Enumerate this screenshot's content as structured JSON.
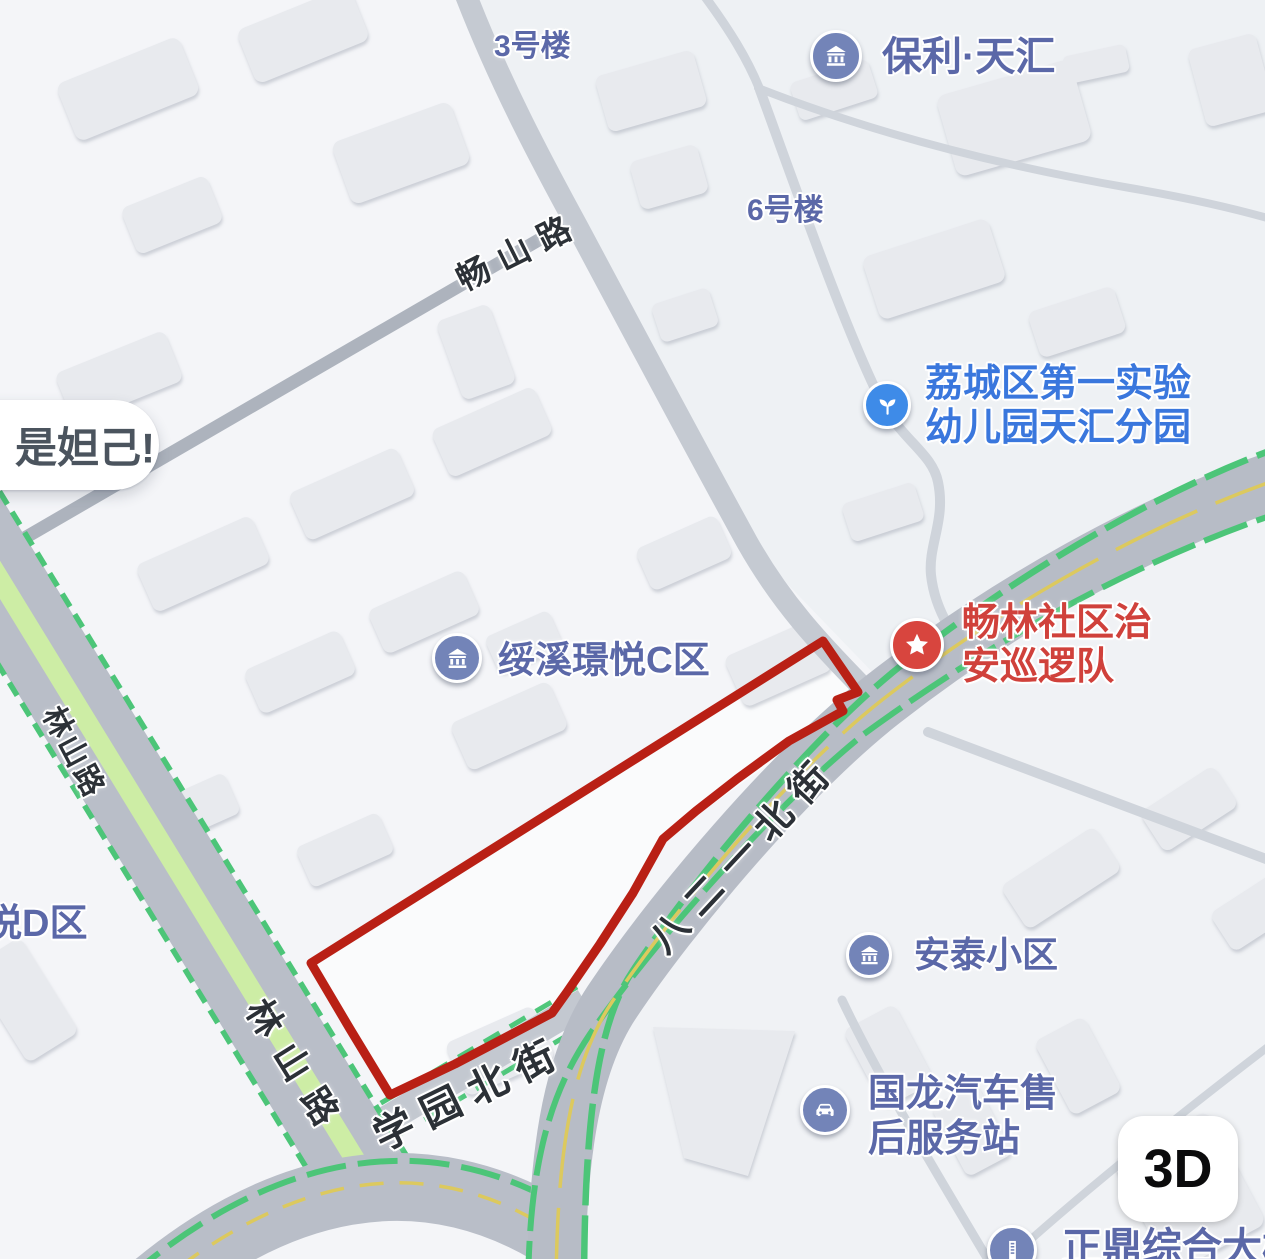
{
  "colors": {
    "poi_blue": "#5b68a8",
    "poi_bright_blue": "#3a77dd",
    "poi_red": "#d0413b",
    "pin_slate": "#7384b8",
    "pin_blue": "#3e8be8",
    "pin_red": "#d8453e",
    "road_gray": "#b7bcc6",
    "green_edge": "#4cc578",
    "median_green": "#cdeda5",
    "yellow_line": "#dcc95e",
    "boundary_red": "#b92015"
  },
  "controls": {
    "view_3d": "3D"
  },
  "bubble": {
    "text": "是妲己!"
  },
  "roads": {
    "changshan": "畅山路",
    "linshan_upper": "林山路",
    "linshan_lower": "林山路",
    "bayeryi": "八二一北街",
    "xueyuan": "学园北街"
  },
  "blocks": {
    "b3": "3号楼",
    "b6": "6号楼",
    "yueD": "悦D区"
  },
  "pois": {
    "baoli": {
      "name": "保利·天汇"
    },
    "kindergarten": {
      "line1": "荔城区第一实验",
      "line2": "幼儿园天汇分园"
    },
    "patrol": {
      "line1": "畅林社区治",
      "line2": "安巡逻队"
    },
    "suixi": {
      "name": "绥溪璟悦C区"
    },
    "antai": {
      "name": "安泰小区"
    },
    "guolong": {
      "line1": "国龙汽车售",
      "line2": "后服务站"
    },
    "zhengding": {
      "name": "正鼎综合大楼"
    }
  },
  "annotation": {
    "type": "boundary-polygon",
    "color": "#b92015"
  }
}
